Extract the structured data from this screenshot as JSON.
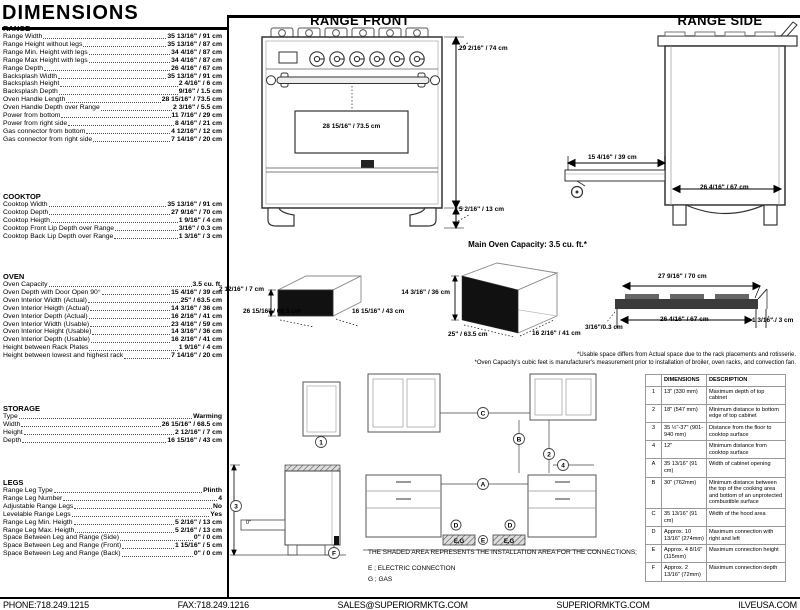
{
  "title": "DIMENSIONS",
  "spec_sections": [
    {
      "heading": "RANGE",
      "rows": [
        {
          "label": "Range Width",
          "value": "35 13/16\" / 91 cm"
        },
        {
          "label": "Range Height without legs",
          "value": "35 13/16\" / 87 cm"
        },
        {
          "label": "Range Min. Height with legs",
          "value": "34 4/16\" / 87 cm"
        },
        {
          "label": "Range Max Height with legs",
          "value": "34 4/16\" / 87 cm"
        },
        {
          "label": "Range Depth",
          "value": "26 4/16\" / 67 cm"
        },
        {
          "label": "Backsplash Width",
          "value": "35 13/16\" / 91 cm"
        },
        {
          "label": "Backsplash Height",
          "value": "2 4/16\" / 6 cm"
        },
        {
          "label": "Backsplash Depth",
          "value": "9/16\" / 1.5 cm"
        },
        {
          "label": "Oven Handle Length",
          "value": "28 15/16\" / 73.5 cm"
        },
        {
          "label": "Oven Handle Depth over Range",
          "value": "2 3/16\" / 5.5 cm"
        },
        {
          "label": "Power from bottom",
          "value": "11 7/16\" / 29 cm"
        },
        {
          "label": "Power from right side",
          "value": "8 4/16\" / 21 cm"
        },
        {
          "label": "Gas connector from bottom",
          "value": "4 12/16\" / 12 cm"
        },
        {
          "label": "Gas connector from right side",
          "value": "7 14/16\" / 20 cm"
        }
      ]
    },
    {
      "heading": "COOKTOP",
      "rows": [
        {
          "label": "Cooktop Width",
          "value": "35 13/16\" / 91 cm"
        },
        {
          "label": "Cooktop Depth",
          "value": "27 9/16\" / 70 cm"
        },
        {
          "label": "Cooktop Heigth",
          "value": "1 9/16\" / 4 cm"
        },
        {
          "label": "Cooktop Front Lip Depth over Range",
          "value": "3/16\" / 0.3 cm"
        },
        {
          "label": "Cooktop Back Lip Depth over Range",
          "value": "1 3/16\" / 3 cm"
        }
      ]
    },
    {
      "heading": "OVEN",
      "rows": [
        {
          "label": "Oven Capacity",
          "value": "3.5 cu. ft."
        },
        {
          "label": "Oven Depth with Door Open 90°",
          "value": "15 4/16\" / 39 cm"
        },
        {
          "label": "Oven Interior Width (Actual)",
          "value": "25\" / 63.5 cm"
        },
        {
          "label": "Oven Interior Heigth (Actual)",
          "value": "14 3/16\" / 36 cm"
        },
        {
          "label": "Oven Interior Depth (Actual)",
          "value": "16 2/16\" / 41 cm"
        },
        {
          "label": "Oven Interior Width (Usable)",
          "value": "23 4/16\" / 59 cm"
        },
        {
          "label": "Oven Interior Height (Usable)",
          "value": "14 3/16\" / 36 cm"
        },
        {
          "label": "Oven Interior Depth (Usable)",
          "value": "16 2/16\" / 41 cm"
        },
        {
          "label": "Height between Rack Plates",
          "value": "1 9/16\" / 4 cm"
        },
        {
          "label": "Height between lowest and highest rack",
          "value": "7 14/16\" / 20 cm"
        }
      ]
    },
    {
      "heading": "STORAGE",
      "rows": [
        {
          "label": "Type",
          "value": "Warming"
        },
        {
          "label": "Width",
          "value": "26 15/16\" / 68.5 cm"
        },
        {
          "label": "Height",
          "value": "2 12/16\" / 7 cm"
        },
        {
          "label": "Depth",
          "value": "16 15/16\" / 43 cm"
        }
      ]
    },
    {
      "heading": "LEGS",
      "rows": [
        {
          "label": "Range Leg Type",
          "value": "Plinth"
        },
        {
          "label": "Range Leg Number",
          "value": "4"
        },
        {
          "label": "Adjustable Range Legs",
          "value": "No"
        },
        {
          "label": "Levelable Range Legs",
          "value": "Yes"
        },
        {
          "label": "Range Leg Min. Heigth",
          "value": "5 2/16\" / 13 cm"
        },
        {
          "label": "Range Leg Max. Heigth",
          "value": "5 2/16\" / 13 cm"
        },
        {
          "label": "Space Between Leg and Range (Side)",
          "value": "0\" / 0 cm"
        },
        {
          "label": "Space Between Leg and Range (Front)",
          "value": "1 15/16\" / 5 cm"
        },
        {
          "label": "Space Between Leg and Range (Back)",
          "value": "0\" / 0 cm"
        }
      ]
    }
  ],
  "drawings": {
    "range_front": {
      "title": "RANGE FRONT",
      "height_label": "29 2/16\" / 74 cm",
      "handle_label": "28 15/16\" / 73.5 cm",
      "leg_label": "5 2/16\" / 13 cm"
    },
    "range_side": {
      "title": "RANGE SIDE",
      "door_label": "15 4/16\" / 39 cm",
      "depth_label": "26 4/16\" / 67 cm"
    },
    "capacity_note": "Main Oven Capacity: 3.5 cu. ft.*",
    "storage_drawer": {
      "height_label": "2 12/16\" / 7 cm",
      "width_label": "26 15/16\" / 68.5 cm",
      "depth_label": "16 15/16\" / 43 cm"
    },
    "oven_interior": {
      "height_label": "14 3/16\" / 36 cm",
      "width_label": "25\" / 63.5 cm",
      "depth_label": "16 2/16\" / 41 cm"
    },
    "cooktop_profile": {
      "width_label": "27 9/16\" / 70 cm",
      "inner_label": "26 4/16\" / 67 cm",
      "front_lip_label": "3/16\"/0.3 cm",
      "back_lip_label": "1 3/16\" / 3 cm"
    }
  },
  "footnotes": [
    "*Usable space differs from Actual space due to the rack placements and rotisserie.",
    "*Oven Capacity's cubic feet is manufacturer's measurement prior to installation of broiler, oven racks, and convection fan."
  ],
  "installation": {
    "callouts": {
      "n1": "1",
      "n2": "2",
      "n3": "3",
      "n4": "4",
      "A": "A",
      "B": "B",
      "C": "C",
      "D": "D",
      "E": "E",
      "F": "F",
      "eg": "E,G"
    },
    "zero_label": "0\"",
    "notes": [
      "THE SHADED AREA REPRESENTS THE INSTALLATION AREA FOR THE CONNECTIONS;",
      "E ; ELECTRIC CONNECTION",
      "G ; GAS"
    ],
    "table": {
      "headers": [
        "",
        "DIMENSIONS",
        "DESCRIPTION"
      ],
      "rows": [
        [
          "1",
          "13\" (330 mm)",
          "Maximum depth of top cabinet"
        ],
        [
          "2",
          "18\" (547 mm)",
          "Minimum distance to bottom edge of top cabinet"
        ],
        [
          "3",
          "35 ½\"-37\" (901-940 mm)",
          "Distance from the floor to cooktop surface"
        ],
        [
          "4",
          "12\"",
          "Minimum distance from cooktop surface"
        ],
        [
          "A",
          "35 13/16\" (91 cm)",
          "Width of cabinet opening"
        ],
        [
          "B",
          "30\" (762mm)",
          "Minimum distance between the top of the cooking area and bottom of an unprotected combustible surface"
        ],
        [
          "C",
          "35 13/16\" (91 cm)",
          "Width of the hood area"
        ],
        [
          "D",
          "Approx. 10 13/16\" (274mm)",
          "Maximum connection with right and left"
        ],
        [
          "E",
          "Approx. 4 8/16\" (115mm)",
          "Maximum connection height"
        ],
        [
          "F",
          "Approx. 2 13/16\" (72mm)",
          "Maximum connection depth"
        ]
      ]
    }
  },
  "footer": {
    "phone": "PHONE:718.249.1215",
    "fax": "FAX:718.249.1216",
    "email": "SALES@SUPERIORMKTG.COM",
    "website": "SUPERIORMKTG.COM",
    "brand": "ILVEUSA.COM"
  }
}
